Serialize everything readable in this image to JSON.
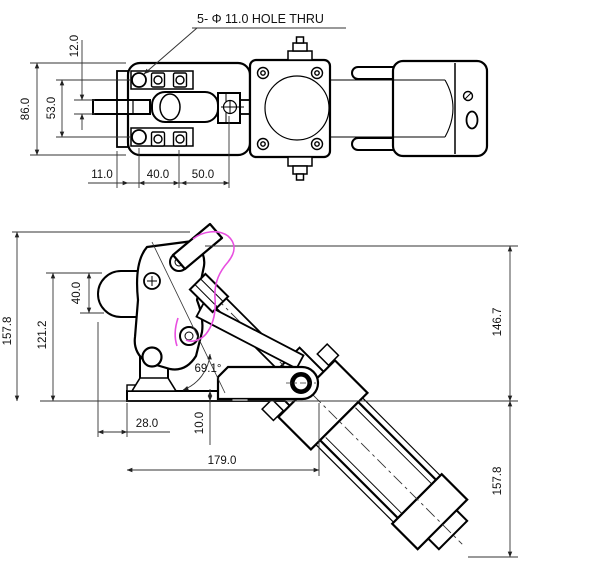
{
  "drawing": {
    "type": "engineering-drawing",
    "colors": {
      "background": "#ffffff",
      "line": "#000000",
      "dim": "#222222",
      "highlight": "#e84fe0"
    },
    "top_view": {
      "hole_note": "5- Φ 11.0  HOLE THRU",
      "dims": {
        "overall_height": "86.0",
        "hole_spacing": "53.0",
        "bar_thickness": "12.0",
        "flange_width": "11.0",
        "bolt_spacing": "40.0",
        "rod_to_mark": "50.0"
      }
    },
    "front_view": {
      "dims": {
        "overall_height_left": "157.8",
        "pivot_height": "121.2",
        "boss_drop": "40.0",
        "open_angle": "69.1°",
        "base_overhang": "28.0",
        "base_thickness": "10.0",
        "base_length": "179.0",
        "height_above_base": "146.7",
        "cylinder_drop_below_base": "157.8"
      }
    }
  }
}
